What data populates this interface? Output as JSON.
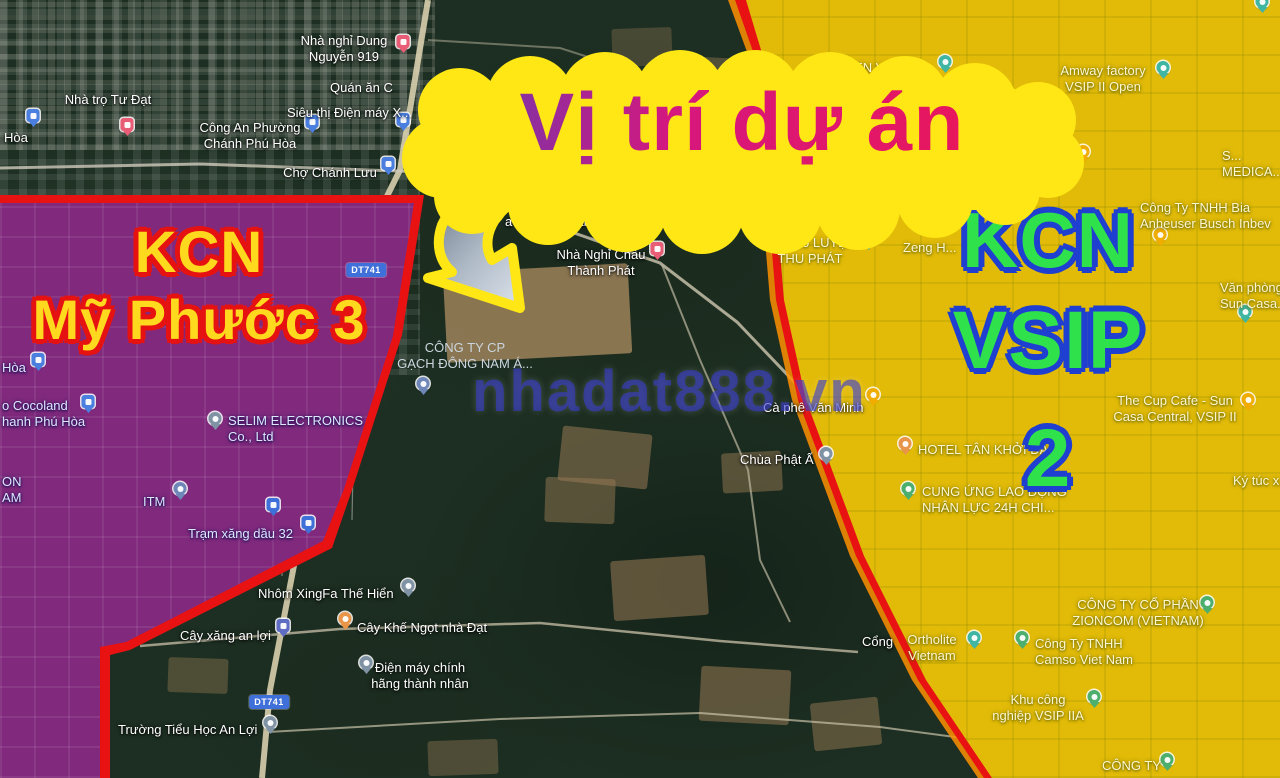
{
  "title": {
    "text": "Vị trí dự án"
  },
  "watermark": {
    "text": "nhadat888.vn"
  },
  "zones": {
    "left": {
      "line1": "KCN",
      "line2": "Mỹ Phước 3",
      "fill_color": "#ffd91e",
      "outline_color": "#e61212",
      "overlay_color": "#2b3ed5"
    },
    "right": {
      "line1": "KCN",
      "line2": "VSIP 2",
      "fill_color": "#2fe24b",
      "outline_color": "#1f3fd0",
      "overlay_color": "#e0e606"
    }
  },
  "colors": {
    "boundary_red": "#e81212",
    "boundary_glow_orange": "#ff9100",
    "headline_pink": "#e8175d",
    "headline_purple": "#8b2fa0",
    "cloud_yellow": "#ffe715"
  },
  "road_badges": [
    {
      "text": "DT741",
      "x": 366,
      "y": 270
    },
    {
      "text": "DT741",
      "x": 269,
      "y": 702
    }
  ],
  "poi_labels": [
    {
      "lines": [
        "Nhà nghỉ Dung",
        "Nguyễn 919"
      ],
      "x": 344,
      "y": 33,
      "align": "center",
      "side": "dark"
    },
    {
      "lines": [
        "Quán ăn C"
      ],
      "x": 330,
      "y": 80,
      "align": "left",
      "side": "dark"
    },
    {
      "lines": [
        "Siêu thị Điện máy X..."
      ],
      "x": 287,
      "y": 105,
      "align": "left",
      "side": "dark"
    },
    {
      "lines": [
        "Hòa"
      ],
      "x": 4,
      "y": 130,
      "align": "left",
      "side": "dark"
    },
    {
      "lines": [
        "Công An Phường",
        "Chánh Phú Hòa"
      ],
      "x": 250,
      "y": 120,
      "align": "center",
      "side": "dark"
    },
    {
      "lines": [
        "Nhà trọ Tư Đạt"
      ],
      "x": 108,
      "y": 92,
      "align": "center",
      "side": "dark"
    },
    {
      "lines": [
        "Chợ Chánh Lưu"
      ],
      "x": 330,
      "y": 165,
      "align": "center",
      "side": "dark"
    },
    {
      "lines": [
        "Karaoke Minh"
      ],
      "x": 682,
      "y": 162,
      "align": "left",
      "side": "dark"
    },
    {
      "lines": [
        "Phê Cá Koi",
        "a Phương Nam"
      ],
      "x": 505,
      "y": 198,
      "align": "left",
      "side": "dark"
    },
    {
      "lines": [
        "Nhà Nghỉ Châu",
        "Thành Phát"
      ],
      "x": 601,
      "y": 247,
      "align": "center",
      "side": "dark"
    },
    {
      "lines": [
        "CÔNG TY CP",
        "GẠCH ĐÔNG NAM Á..."
      ],
      "x": 465,
      "y": 340,
      "align": "center",
      "side": "muted"
    },
    {
      "lines": [
        "Cà phê Văn Minh"
      ],
      "x": 763,
      "y": 400,
      "align": "left",
      "side": "dark"
    },
    {
      "lines": [
        "Chùa Phật Ấ"
      ],
      "x": 740,
      "y": 452,
      "align": "left",
      "side": "dark"
    },
    {
      "lines": [
        "Cổng"
      ],
      "x": 862,
      "y": 634,
      "align": "left",
      "side": "dark"
    },
    {
      "lines": [
        "SELIM ELECTRONICS",
        "Co., Ltd"
      ],
      "x": 228,
      "y": 413,
      "align": "left",
      "side": "blue"
    },
    {
      "lines": [
        "ITM"
      ],
      "x": 143,
      "y": 494,
      "align": "left",
      "side": "blue"
    },
    {
      "lines": [
        "Trạm xăng dầu 32"
      ],
      "x": 188,
      "y": 526,
      "align": "left",
      "side": "blue"
    },
    {
      "lines": [
        "Hòa"
      ],
      "x": 2,
      "y": 360,
      "align": "left",
      "side": "blue"
    },
    {
      "lines": [
        "o Cocoland",
        "hanh Phú Hòa"
      ],
      "x": 2,
      "y": 398,
      "align": "left",
      "side": "blue"
    },
    {
      "lines": [
        "ON",
        "AM"
      ],
      "x": 2,
      "y": 474,
      "align": "left",
      "side": "blue"
    },
    {
      "lines": [
        "Nhôm XingFa Thế Hiển"
      ],
      "x": 258,
      "y": 586,
      "align": "left",
      "side": "dark"
    },
    {
      "lines": [
        "Cây xăng an lợi"
      ],
      "x": 180,
      "y": 628,
      "align": "left",
      "side": "dark"
    },
    {
      "lines": [
        "Cây Khế Ngọt nhà Đạt"
      ],
      "x": 357,
      "y": 620,
      "align": "left",
      "side": "dark"
    },
    {
      "lines": [
        "Điện máy chính",
        "hãng thành nhân"
      ],
      "x": 420,
      "y": 660,
      "align": "center",
      "side": "dark"
    },
    {
      "lines": [
        "Trường Tiểu Học An Lợi"
      ],
      "x": 118,
      "y": 722,
      "align": "left",
      "side": "dark"
    },
    {
      "lines": [
        "UNIBEN VSIP II-A"
      ],
      "x": 823,
      "y": 60,
      "align": "left",
      "side": "yellow"
    },
    {
      "lines": [
        "Amway factory",
        "VSIP II Open"
      ],
      "x": 1103,
      "y": 63,
      "align": "center",
      "side": "yellow"
    },
    {
      "lines": [
        "URC Coffee",
        "Creamer Factory"
      ],
      "x": 1025,
      "y": 145,
      "align": "center",
      "side": "yellow"
    },
    {
      "lines": [
        "Trạm 3"
      ],
      "x": 768,
      "y": 160,
      "align": "left",
      "side": "yellow"
    },
    {
      "lines": [
        "S...",
        "MEDICA..."
      ],
      "x": 1222,
      "y": 148,
      "align": "left",
      "side": "yellow"
    },
    {
      "lines": [
        "Cầm đồ LUYỆN",
        "THU PHÁT"
      ],
      "x": 810,
      "y": 235,
      "align": "center",
      "side": "yellow"
    },
    {
      "lines": [
        "Zeng H..."
      ],
      "x": 903,
      "y": 240,
      "align": "left",
      "side": "yellow"
    },
    {
      "lines": [
        "Công Ty TNHH Bia",
        "Anheuser Busch Inbev"
      ],
      "x": 1140,
      "y": 200,
      "align": "left",
      "side": "yellow"
    },
    {
      "lines": [
        "Văn phòng",
        "Sun Casa..."
      ],
      "x": 1220,
      "y": 280,
      "align": "left",
      "side": "yellow"
    },
    {
      "lines": [
        "The Cup Cafe - Sun",
        "Casa Central, VSIP II"
      ],
      "x": 1175,
      "y": 393,
      "align": "center",
      "side": "yellow"
    },
    {
      "lines": [
        "HOTEL TÂN KHỞI ĐẠT"
      ],
      "x": 918,
      "y": 442,
      "align": "left",
      "side": "yellow"
    },
    {
      "lines": [
        "CUNG ỨNG LAO ĐỘNG",
        "NHÂN LỰC 24H CHI..."
      ],
      "x": 922,
      "y": 484,
      "align": "left",
      "side": "yellow"
    },
    {
      "lines": [
        "Ký túc x..."
      ],
      "x": 1233,
      "y": 473,
      "align": "left",
      "side": "yellow"
    },
    {
      "lines": [
        "Ortholite",
        "Vietnam"
      ],
      "x": 932,
      "y": 632,
      "align": "center",
      "side": "yellow"
    },
    {
      "lines": [
        "CÔNG TY CỔ PHẦN",
        "ZIONCOM (VIETNAM)"
      ],
      "x": 1138,
      "y": 597,
      "align": "center",
      "side": "yellow"
    },
    {
      "lines": [
        "Công Ty TNHH",
        "Camso Viet Nam"
      ],
      "x": 1035,
      "y": 636,
      "align": "left",
      "side": "yellow"
    },
    {
      "lines": [
        "Khu công",
        "nghiệp VSIP IIA"
      ],
      "x": 1038,
      "y": 692,
      "align": "center",
      "side": "yellow"
    },
    {
      "lines": [
        "CÔNG TY"
      ],
      "x": 1102,
      "y": 758,
      "align": "left",
      "side": "yellow"
    }
  ],
  "pins": [
    {
      "type": "lodging",
      "shape": "sq",
      "color": "#e85d75",
      "x": 403,
      "y": 48
    },
    {
      "type": "shopping",
      "shape": "sq",
      "color": "#4a7fe0",
      "x": 403,
      "y": 126
    },
    {
      "type": "police",
      "shape": "sq",
      "color": "#4a7fe0",
      "x": 312,
      "y": 128
    },
    {
      "type": "shopping",
      "shape": "sq",
      "color": "#4a7fe0",
      "x": 33,
      "y": 122
    },
    {
      "type": "lodging",
      "shape": "sq",
      "color": "#e85d75",
      "x": 127,
      "y": 131
    },
    {
      "type": "market",
      "shape": "sq",
      "color": "#4a7fe0",
      "x": 388,
      "y": 170
    },
    {
      "type": "lodging",
      "shape": "sq",
      "color": "#e85d75",
      "x": 657,
      "y": 255
    },
    {
      "type": "factory",
      "shape": "c",
      "color": "#6f87b8",
      "x": 423,
      "y": 390
    },
    {
      "type": "cafe",
      "shape": "c",
      "color": "#f0ad00",
      "x": 873,
      "y": 401
    },
    {
      "type": "temple",
      "shape": "c",
      "color": "#8093a5",
      "x": 826,
      "y": 460
    },
    {
      "type": "factory",
      "shape": "c",
      "color": "#8093a5",
      "x": 215,
      "y": 425
    },
    {
      "type": "generic",
      "shape": "c",
      "color": "#6f87b8",
      "x": 180,
      "y": 495
    },
    {
      "type": "transit",
      "shape": "sq",
      "color": "#3f6fd8",
      "x": 308,
      "y": 529
    },
    {
      "type": "transit",
      "shape": "sq",
      "color": "#3f6fd8",
      "x": 273,
      "y": 511
    },
    {
      "type": "generic",
      "shape": "c",
      "color": "#8093a5",
      "x": 408,
      "y": 592
    },
    {
      "type": "gas-station",
      "shape": "sq",
      "color": "#5f6cc4",
      "x": 283,
      "y": 632
    },
    {
      "type": "drink",
      "shape": "c",
      "color": "#e8954a",
      "x": 345,
      "y": 625
    },
    {
      "type": "generic",
      "shape": "c",
      "color": "#8093a5",
      "x": 366,
      "y": 669
    },
    {
      "type": "school",
      "shape": "c",
      "color": "#8093a5",
      "x": 270,
      "y": 729
    },
    {
      "type": "shopping",
      "shape": "sq",
      "color": "#4a7fe0",
      "x": 38,
      "y": 366
    },
    {
      "type": "shopping",
      "shape": "sq",
      "color": "#4a7fe0",
      "x": 88,
      "y": 408
    },
    {
      "type": "factory",
      "shape": "c",
      "color": "#3fb5a3",
      "x": 945,
      "y": 68
    },
    {
      "type": "factory",
      "shape": "c",
      "color": "#3fb5a3",
      "x": 1163,
      "y": 74
    },
    {
      "type": "cafe",
      "shape": "c",
      "color": "#f0ad00",
      "x": 1083,
      "y": 158
    },
    {
      "type": "drink",
      "shape": "c",
      "color": "#f0ad00",
      "x": 820,
      "y": 164
    },
    {
      "type": "factory",
      "shape": "c",
      "color": "#3fb5a3",
      "x": 850,
      "y": 188
    },
    {
      "type": "pawn-shop",
      "shape": "c",
      "color": "#3fb5a3",
      "x": 868,
      "y": 245
    },
    {
      "type": "factory",
      "shape": "c",
      "color": "#f0ad00",
      "x": 1160,
      "y": 241
    },
    {
      "type": "office",
      "shape": "c",
      "color": "#3fb5a3",
      "x": 1245,
      "y": 318
    },
    {
      "type": "cafe",
      "shape": "c",
      "color": "#f0ad00",
      "x": 1248,
      "y": 406
    },
    {
      "type": "hotel",
      "shape": "c",
      "color": "#e8954a",
      "x": 905,
      "y": 450
    },
    {
      "type": "office",
      "shape": "c",
      "color": "#4caf6e",
      "x": 908,
      "y": 495
    },
    {
      "type": "factory",
      "shape": "c",
      "color": "#3fb5a3",
      "x": 974,
      "y": 644
    },
    {
      "type": "factory",
      "shape": "c",
      "color": "#4caf6e",
      "x": 1207,
      "y": 609
    },
    {
      "type": "factory",
      "shape": "c",
      "color": "#4caf6e",
      "x": 1022,
      "y": 644
    },
    {
      "type": "industrial-park",
      "shape": "c",
      "color": "#4caf6e",
      "x": 1094,
      "y": 703
    },
    {
      "type": "factory",
      "shape": "c",
      "color": "#4caf6e",
      "x": 1167,
      "y": 766
    },
    {
      "type": "factory",
      "shape": "c",
      "color": "#3fb5a3",
      "x": 1262,
      "y": 8
    }
  ]
}
